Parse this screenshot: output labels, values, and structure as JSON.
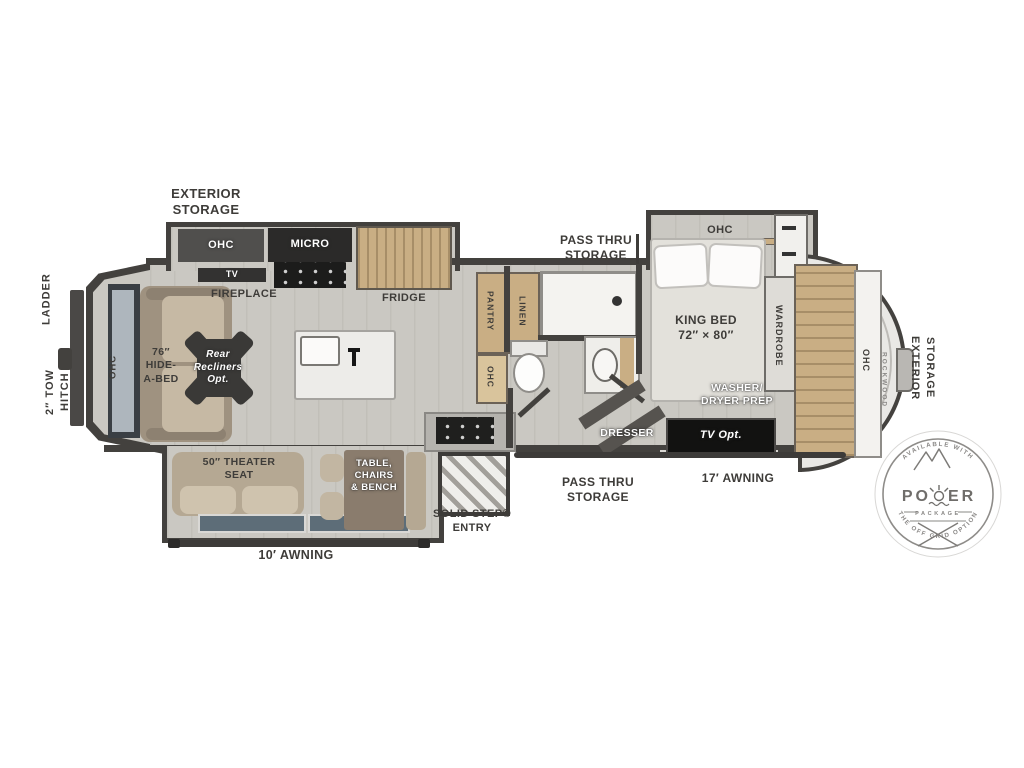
{
  "labels": {
    "ladder": "LADDER",
    "tow_hitch": "2″ TOW\nHITCH",
    "rear_ohc": "OHC",
    "hide_a_bed": "76″\nHIDE-\nA-BED",
    "recliners": "Rear\nRecliners\nOpt.",
    "ext_storage_top": "EXTERIOR\nSTORAGE",
    "kitchen_ohc": "OHC",
    "micro": "MICRO",
    "tv": "TV",
    "fireplace": "FIREPLACE",
    "fridge": "FRIDGE",
    "pantry": "PANTRY",
    "linen": "LINEN",
    "bath_ohc": "OHC",
    "pass_thru_top": "PASS THRU\nSTORAGE",
    "bed_ohc": "OHC",
    "king_bed": "KING BED\n72″ × 80″",
    "wardrobe": "WARDROBE",
    "washer_dryer": "WASHER/\nDRYER PREP",
    "dresser": "DRESSER",
    "tv_opt": "TV Opt.",
    "awning_17": "17′ AWNING",
    "pass_thru_bottom": "PASS THRU\nSTORAGE",
    "solid_step": "SOLID STEP®\nENTRY",
    "table_group": "TABLE,\nCHAIRS\n& BENCH",
    "theater_seat": "50″ THEATER\nSEAT",
    "awning_10": "10′ AWNING",
    "front_ohc": "OHC",
    "brand": "ROCKWOOD",
    "ext_storage_front": "EXTERIOR\nSTORAGE"
  },
  "badge": {
    "arc_top": "AVAILABLE WITH",
    "power_word": "POWER",
    "power_left": "PO",
    "power_right": "ER",
    "package": "PACKAGE",
    "arc_bottom": "THE OFF GRID OPTION"
  },
  "colors": {
    "wall": "#43413e",
    "floor": "#cac8c2",
    "wood": "#c9ae84",
    "label": "#3e3c39"
  }
}
